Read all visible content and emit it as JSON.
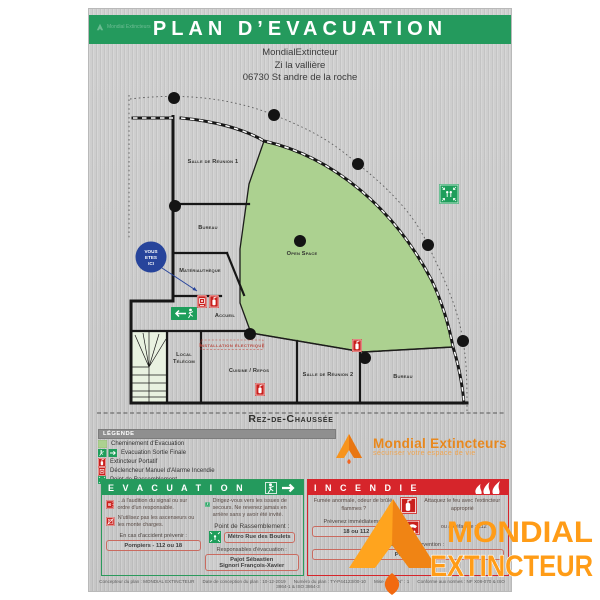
{
  "colors": {
    "accent_green": "#249a5d",
    "accent_red": "#d6252b",
    "plan_green": "#acd190",
    "brand_orange": "#ff9c17",
    "badge_blue": "#27449b"
  },
  "header": {
    "title": "PLAN D’EVACUATION",
    "watermark": "Mondial Extincteurs"
  },
  "address": {
    "line1": "MondialExtincteur",
    "line2": "Zi la vallière",
    "line3": "06730 St andre de la roche"
  },
  "plan": {
    "floor_label": "Rez-de-Chaussée",
    "you_are_here_1": "VOUS",
    "you_are_here_2": "ETES",
    "you_are_here_3": "ICI",
    "room_salle1": "Salle de Réunion 1",
    "room_bureau1": "Bureau",
    "room_materiautheque": "Matériauthèque",
    "room_accueil": "Accueil",
    "room_local_telecom_1": "Local",
    "room_local_telecom_2": "Télécom",
    "room_installation": "Installation  électrique",
    "room_cuisine": "Cuisine / Repos",
    "room_salle2": "Salle de Réunion 2",
    "room_bureau2": "Bureau",
    "room_open_space": "Open Space"
  },
  "legend": {
    "title": "LÉGENDE",
    "items": [
      {
        "icon": "evacuation-path-swatch",
        "label": "Cheminement d'Evacuation"
      },
      {
        "icon": "exit-final-icon",
        "label": "Evacuation Sortie Finale"
      },
      {
        "icon": "extinguisher-icon",
        "label": "Extincteur Portatif"
      },
      {
        "icon": "manual-alarm-icon",
        "label": "Déclencheur Manuel d'Alarme Incendie"
      },
      {
        "icon": "assembly-point-icon",
        "label": "Point de Rassemblement"
      }
    ]
  },
  "brand": {
    "name": "Mondial Extincteurs",
    "tagline": "sécuriser votre espace de vie"
  },
  "evacuation": {
    "title": "E V A C U A T I O N",
    "step1": "...à l'audition du signal ou sur ordre d'un responsable.",
    "step2": "N'utilisez pas les ascenseurs ou les monte charges.",
    "step3": "Dirigez-vous vers les issues de secours. Ne revenez jamais en arrière sans y avoir été invité.",
    "assembly_label": "Point de Rassemblement :",
    "assembly_value": "Métro Rue des Boulets",
    "accident_label": "En cas d'accident prévenir :",
    "accident_value": "Pompiers - 112 ou 18",
    "responsables_label": "Responsables d'évacuation :",
    "responsables_value_1": "Pajot Sébastien",
    "responsables_value_2": "Signori François-Xavier"
  },
  "incendie": {
    "title": "I N C E N D I E",
    "step1": "Fumée anormale, odeur de brûlé, flammes ?",
    "step2": "Attaquez le feu avec l'extincteur approprié",
    "alert_label": "Prévenez immédiatement :",
    "alert_value": "18 ou 112",
    "alert_alt": "ou à défaut le : 112",
    "responsables_label": "Responsables d'intervention :",
    "responsables_value": "Pompiers"
  },
  "footer": {
    "concepteur": "Concepteur du plan : MONDIAL EXTINCTEUR",
    "date": "Date de conception du plan : 10-12-2019",
    "numero": "Numéro du plan : TY-P44123/00-10",
    "maj": "Mise à jour N° : 1",
    "normes": "Conforme aux normes : NF X08-070 & ISO 3864-1 & ISO 3864-3"
  },
  "logo": {
    "line1": "MONDIAL",
    "line2": "EXTINCTEUR"
  }
}
